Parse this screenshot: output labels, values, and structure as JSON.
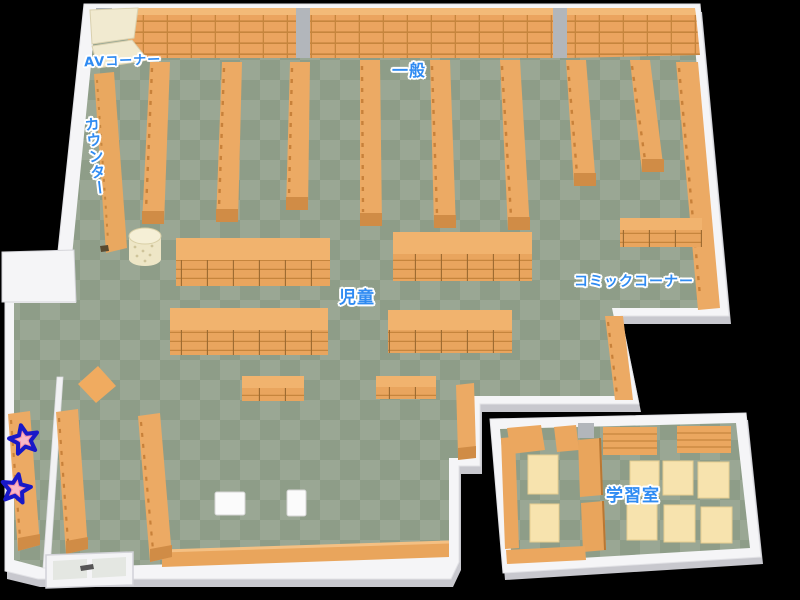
{
  "labels": {
    "av_corner": "AVコーナー",
    "general": "一般",
    "counter": "カウンター",
    "children": "児童",
    "comic_corner": "コミックコーナー",
    "study_room": "学習室"
  },
  "markers": {
    "star_count": "2"
  },
  "colors": {
    "background": "#000000",
    "floor_light": "#9aa794",
    "floor_dark": "#8e9d88",
    "shelf": "#ecaa64",
    "shelf_line": "#c6853d",
    "shelf_end": "#d08c46",
    "shelf_top": "#f3ba78",
    "wall": "#f5f5f7",
    "wall_shadow": "#c8c8ce",
    "pillar": "#b2b6bb",
    "av_shelf": "#f1ead0",
    "table": "#f7e3ae",
    "label_text": "#2f8bf2",
    "label_outline": "#ffffff",
    "star_fill": "#f590a5",
    "star_outline": "#1818c8"
  }
}
